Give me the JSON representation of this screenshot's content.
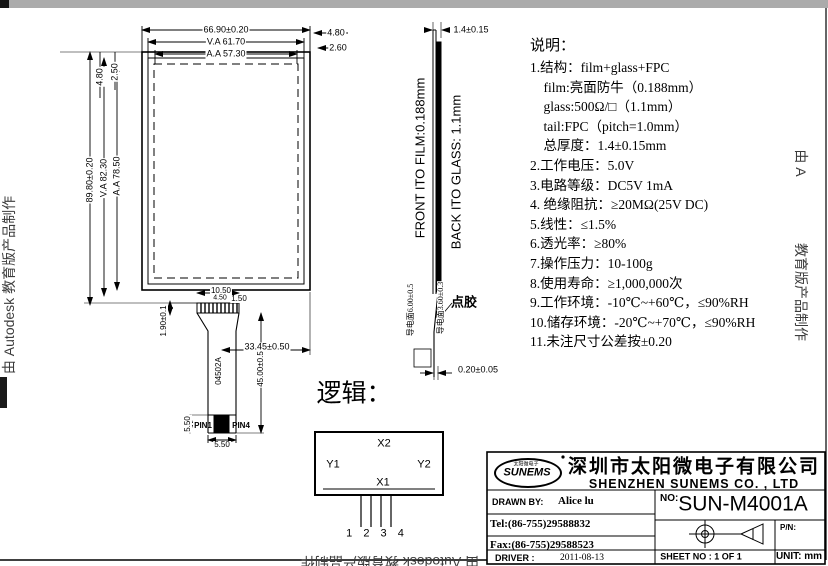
{
  "watermarks": {
    "left": "由 Autodesk 教育版产品制作",
    "right_top": "由 A",
    "right_bottom": "教育版产品制作",
    "bottom": "由 Autodesk 教育版产品制作"
  },
  "front_view": {
    "dim_width_outer": "66.90±0.20",
    "dim_width_va": "V.A 61.70",
    "dim_width_aa": "A.A 57.30",
    "dim_left_offset_aa": "4.80",
    "dim_left_offset_va": "2.50",
    "dim_right_offset_aa": "4.80",
    "dim_right_offset_va": "2.60",
    "dim_height_outer": "89.80±0.20",
    "dim_height_va": "V.A 82.30",
    "dim_height_aa": "A.A 78.50",
    "dim_tail_width": "10.50",
    "dim_tail_pitch": "4.50",
    "dim_tail_edge": "1.50",
    "dim_tail_thick": "1.90±0.1",
    "tail_part_no": "04502A",
    "dim_tail_length": "45.00±0.5",
    "dim_tail_offset": "33.45±0.50",
    "pin1": "PIN1",
    "pin4": "PIN4",
    "dim_pin_block_width": "5.50",
    "dim_pin_block_height": "5.50"
  },
  "side_view": {
    "film_label": "FRONT ITO FILM:0.188mm",
    "glass_label": "BACK ITO GLASS: 1.1mm",
    "dim_total_thickness": "1.4±0.15",
    "dim_cond_left": "导电面6.00±0.5",
    "dim_cond_right": "导电面3.60±0.3",
    "glue_label": "点胶",
    "dim_tail_gap": "0.20±0.05"
  },
  "notes": {
    "title": "说明：",
    "body": "1.结构：film+glass+FPC\n    film:亮面防牛（0.188mm）\n    glass:500Ω/□（1.1mm）\n    tail:FPC（pitch=1.0mm）\n    总厚度：1.4±0.15mm\n2.工作电压：5.0V\n3.电路等级：DC5V 1mA\n4. 绝缘阻抗：≥20MΩ(25V DC)\n5.线性：≤1.5%\n6.透光率：≥80%\n7.操作压力：10-100g\n8.使用寿命：≥1,000,000次\n9.工作环境：-10℃~+60℃，≤90%RH\n10.储存环境：-20℃~+70℃，≤90%RH\n11.未注尺寸公差按±0.20"
  },
  "logic": {
    "title": "逻辑：",
    "x2": "X2",
    "y1": "Y1",
    "y2": "Y2",
    "x1": "X1",
    "pins": "1 2 3 4"
  },
  "title_block": {
    "logo_text": "SUNEMS",
    "logo_sub": "太阳微电子",
    "company_cn": "深圳市太阳微电子有限公司",
    "company_en": "SHENZHEN SUNEMS CO. , LTD",
    "drawn_by_label": "DRAWN  BY:",
    "drawn_by": "Alice lu",
    "no_label": "NO:",
    "model_no": "SUN-M4001A",
    "tel": "Tel:(86-755)29588832",
    "fax": "Fax:(86-755)29588523",
    "pn_label": "P/N:",
    "date_label": "DRIVER :",
    "date": "2011-08-13",
    "sheet_label": "SHEET  NO :  1  OF  1",
    "unit_label": "UNIT: mm"
  }
}
